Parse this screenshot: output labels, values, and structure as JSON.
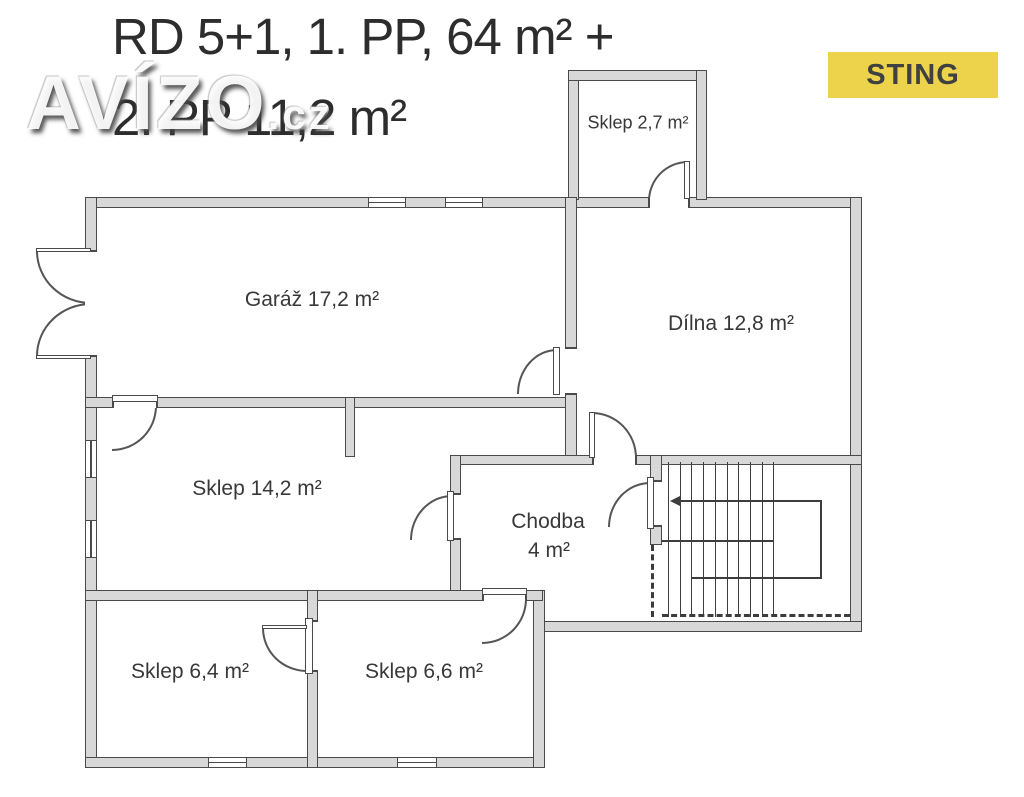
{
  "watermark": {
    "brand": "AVÍZO",
    "suffix": ".cz"
  },
  "badge": {
    "label": "STING",
    "bg": "#EDD34B",
    "fg": "#3F4040"
  },
  "title": {
    "line1": "RD 5+1, 1. PP, 64 m² +",
    "line2": "2. PP 11,2 m²"
  },
  "rooms": [
    {
      "id": "sklep-2-7",
      "label": "Sklep 2,7 m²"
    },
    {
      "id": "garaz",
      "label": "Garáž 17,2 m²"
    },
    {
      "id": "dilna",
      "label": "Dílna 12,8 m²"
    },
    {
      "id": "sklep-14-2",
      "label": "Sklep 14,2 m²"
    },
    {
      "id": "chodba",
      "label": "Chodba",
      "area": "4 m²"
    },
    {
      "id": "sklep-6-4",
      "label": "Sklep 6,4 m²"
    },
    {
      "id": "sklep-6-6",
      "label": "Sklep 6,6 m²"
    }
  ],
  "stairs": {
    "tread_count": 10
  },
  "colors": {
    "wall_fill": "#D8D8D8",
    "wall_line": "#4A4A4A",
    "label_text": "#383838"
  }
}
